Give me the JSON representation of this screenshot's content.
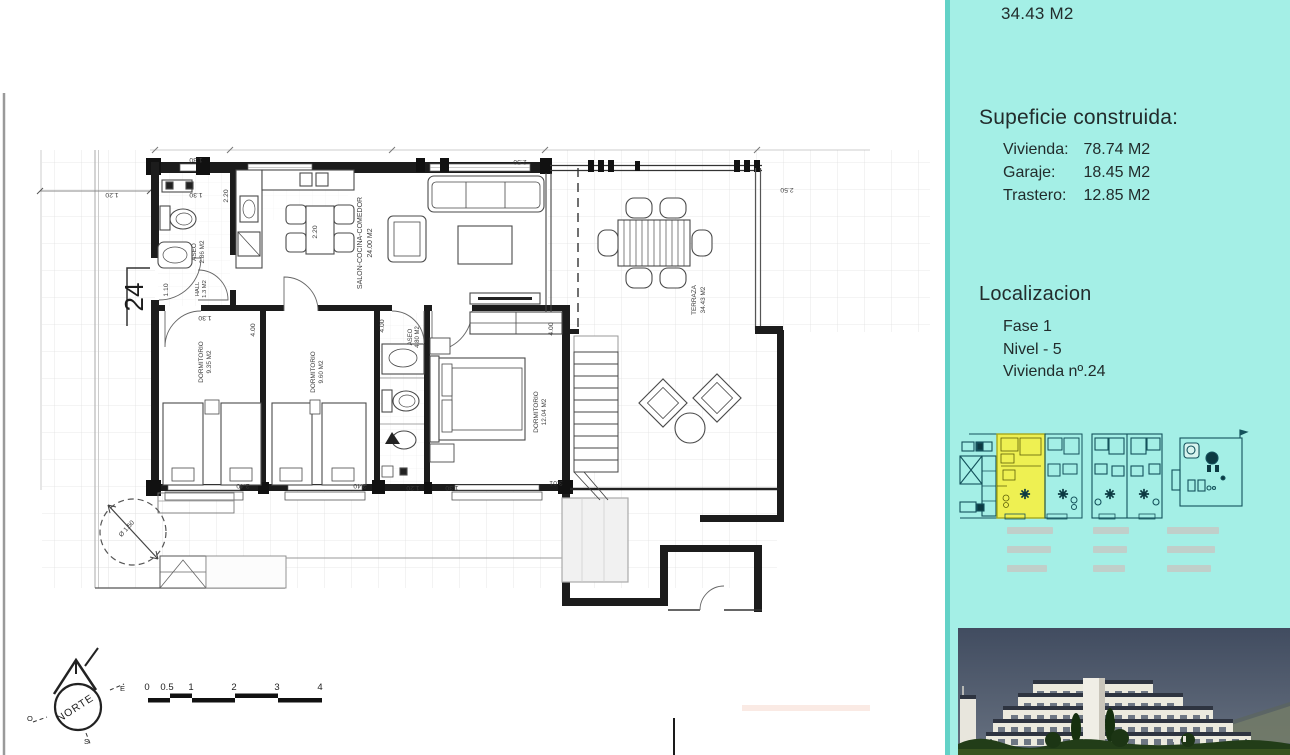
{
  "panel": {
    "top_value": "34.43 M2",
    "surface": {
      "title": "Supeficie construida:",
      "rows": [
        {
          "label": "Vivienda:",
          "value": "78.74 M2"
        },
        {
          "label": "Garaje:",
          "value": "18.45 M2"
        },
        {
          "label": "Trastero:",
          "value": "12.85 M2"
        }
      ]
    },
    "location": {
      "title": "Localizacion",
      "rows": [
        "Fase 1",
        "Nivel - 5",
        "Vivienda nº.24"
      ]
    },
    "colors": {
      "panel_bg": "#a4efe6",
      "panel_edge": "#63d2c7",
      "highlight_unit": "#eef052",
      "thumb_line": "#14525c",
      "photo_sky": "#434e62",
      "photo_green": "#223d18"
    }
  },
  "plan": {
    "unit_number": "24",
    "rooms": {
      "salon": {
        "name": "SALON-COCINA-COMEDOR",
        "area": "24.00 M2"
      },
      "dorm1": {
        "name": "DORMITORIO",
        "area": "9.35 M2"
      },
      "dorm2": {
        "name": "DORMITORIO",
        "area": "9.60 M2"
      },
      "dorm3": {
        "name": "DORMITORIO",
        "area": "12.04 M2"
      },
      "aseo1": {
        "name": "ASEO",
        "area": "2.86 M2"
      },
      "aseo2": {
        "name": "ASEO",
        "area": "4.80 M2"
      },
      "hall": {
        "name": "HALL",
        "area": "1.3 M2"
      },
      "terraza": {
        "name": "TERRAZA",
        "area": "34.43 M2"
      }
    },
    "dims": {
      "d110": "1.10",
      "d120": "1.20",
      "d130": "1.30",
      "d220": "2.20",
      "d240": "2.40",
      "d250": "2.50",
      "d301": "3.01",
      "d400": "4.00",
      "diam": "Ø 1.50"
    },
    "compass": {
      "label": "NORTE",
      "e": "E",
      "o": "O",
      "s": "S"
    },
    "scale": {
      "t0": "0",
      "t1": "0.5",
      "t2": "1",
      "t3": "2",
      "t4": "3",
      "t5": "4"
    }
  }
}
